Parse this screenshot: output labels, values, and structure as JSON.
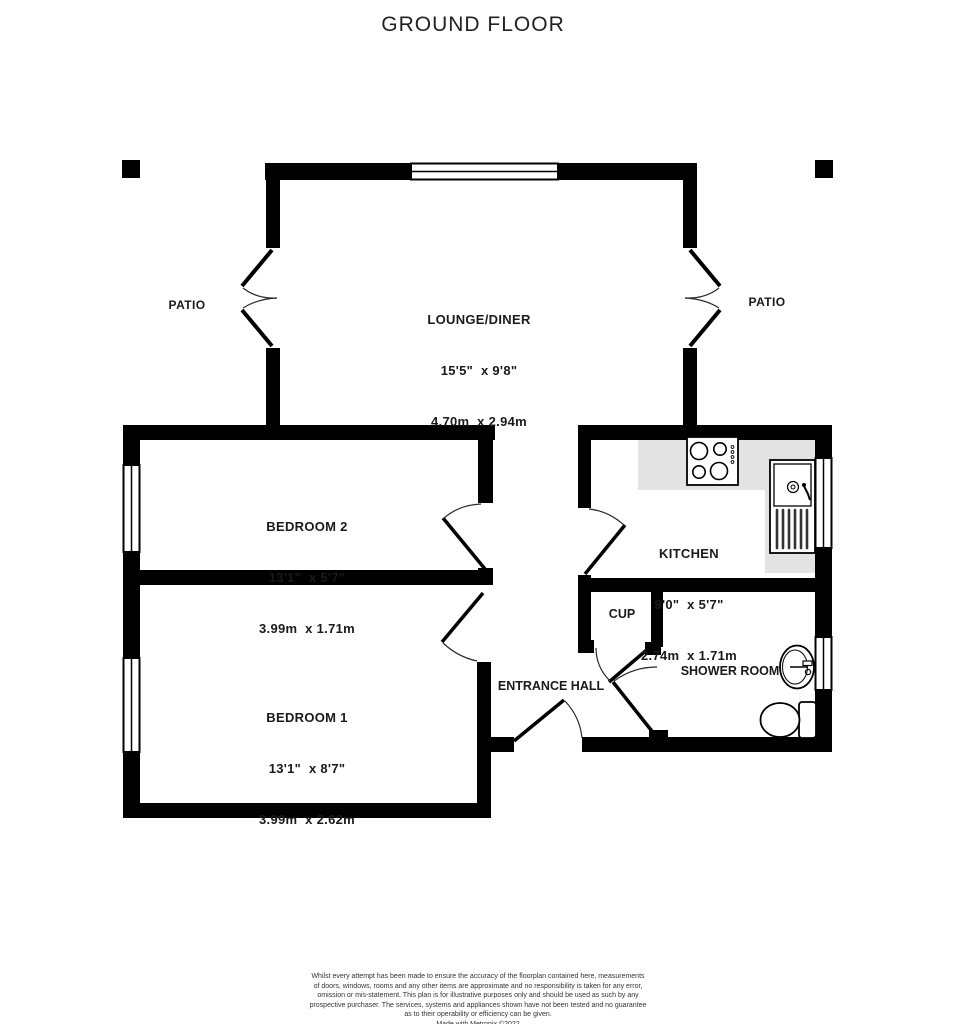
{
  "title": "GROUND FLOOR",
  "rooms": {
    "lounge_diner": {
      "name": "LOUNGE/DINER",
      "size_imperial": "15'5\"  x 9'8\"",
      "size_metric": "4.70m  x 2.94m"
    },
    "bedroom_2": {
      "name": "BEDROOM 2",
      "size_imperial": "13'1\"  x 5'7\"",
      "size_metric": "3.99m  x 1.71m"
    },
    "bedroom_1": {
      "name": "BEDROOM 1",
      "size_imperial": "13'1\"  x 8'7\"",
      "size_metric": "3.99m  x 2.62m"
    },
    "kitchen": {
      "name": "KITCHEN",
      "size_imperial": "9'0\"  x 5'7\"",
      "size_metric": "2.74m  x 1.71m"
    },
    "cupboard": {
      "name": "CUP"
    },
    "shower_room": {
      "name": "SHOWER ROOM"
    },
    "entrance_hall": {
      "name": "ENTRANCE HALL"
    }
  },
  "outside": {
    "patio_left": "PATIO",
    "patio_right": "PATIO"
  },
  "footer": {
    "disclaimer_lines": [
      "Whilst every attempt has been made to ensure the accuracy of the floorplan contained here, measurements",
      "of doors, windows, rooms and any other items are approximate and no responsibility is taken for any error,",
      "omission or mis-statement. This plan is for illustrative purposes only and should be used as such by any",
      "prospective purchaser. The services, systems and appliances shown have not been tested and no guarantee",
      "as to their operability or efficiency can be given."
    ],
    "credit": "Made with Metropix ©2022"
  },
  "colors": {
    "wall": "#000000",
    "counter": "#e3e3e3",
    "background": "#ffffff",
    "text": "#1a1a1a"
  }
}
